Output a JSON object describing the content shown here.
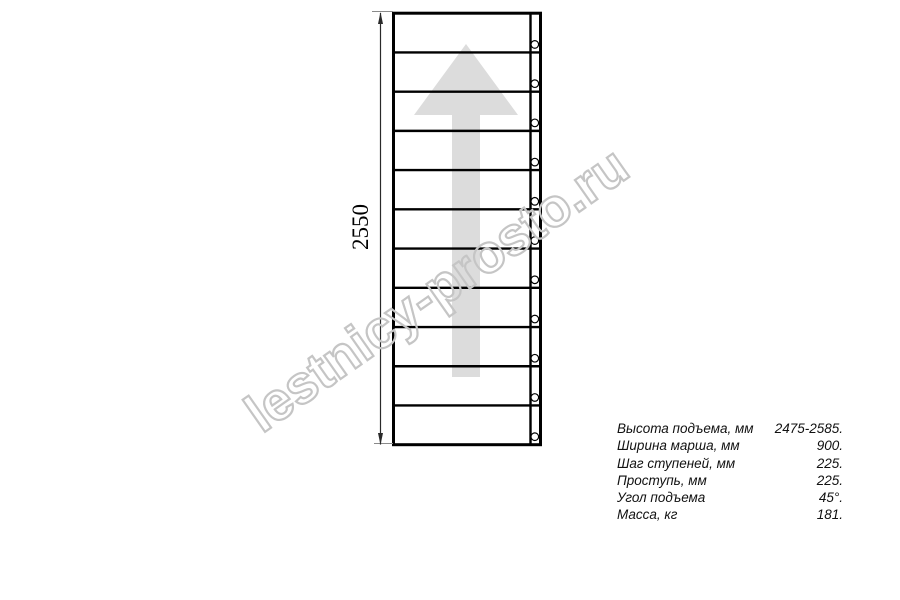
{
  "diagram": {
    "dimension_label": "2550",
    "steps": 11,
    "watermark": "lestnicy-prosto.ru"
  },
  "specs": {
    "rows": [
      {
        "label": "Высота подъема, мм",
        "value": "2475-2585."
      },
      {
        "label": "Ширина марша, мм",
        "value": "900."
      },
      {
        "label": "Шаг ступеней, мм",
        "value": "225."
      },
      {
        "label": "Проступь, мм",
        "value": "225."
      },
      {
        "label": "Угол подъема",
        "value": "45°."
      },
      {
        "label": "Масса, кг",
        "value": "181."
      }
    ]
  },
  "colors": {
    "line": "#000000",
    "arrow_fill": "#dcdcdc",
    "watermark_stroke": "#c5c5c5"
  }
}
